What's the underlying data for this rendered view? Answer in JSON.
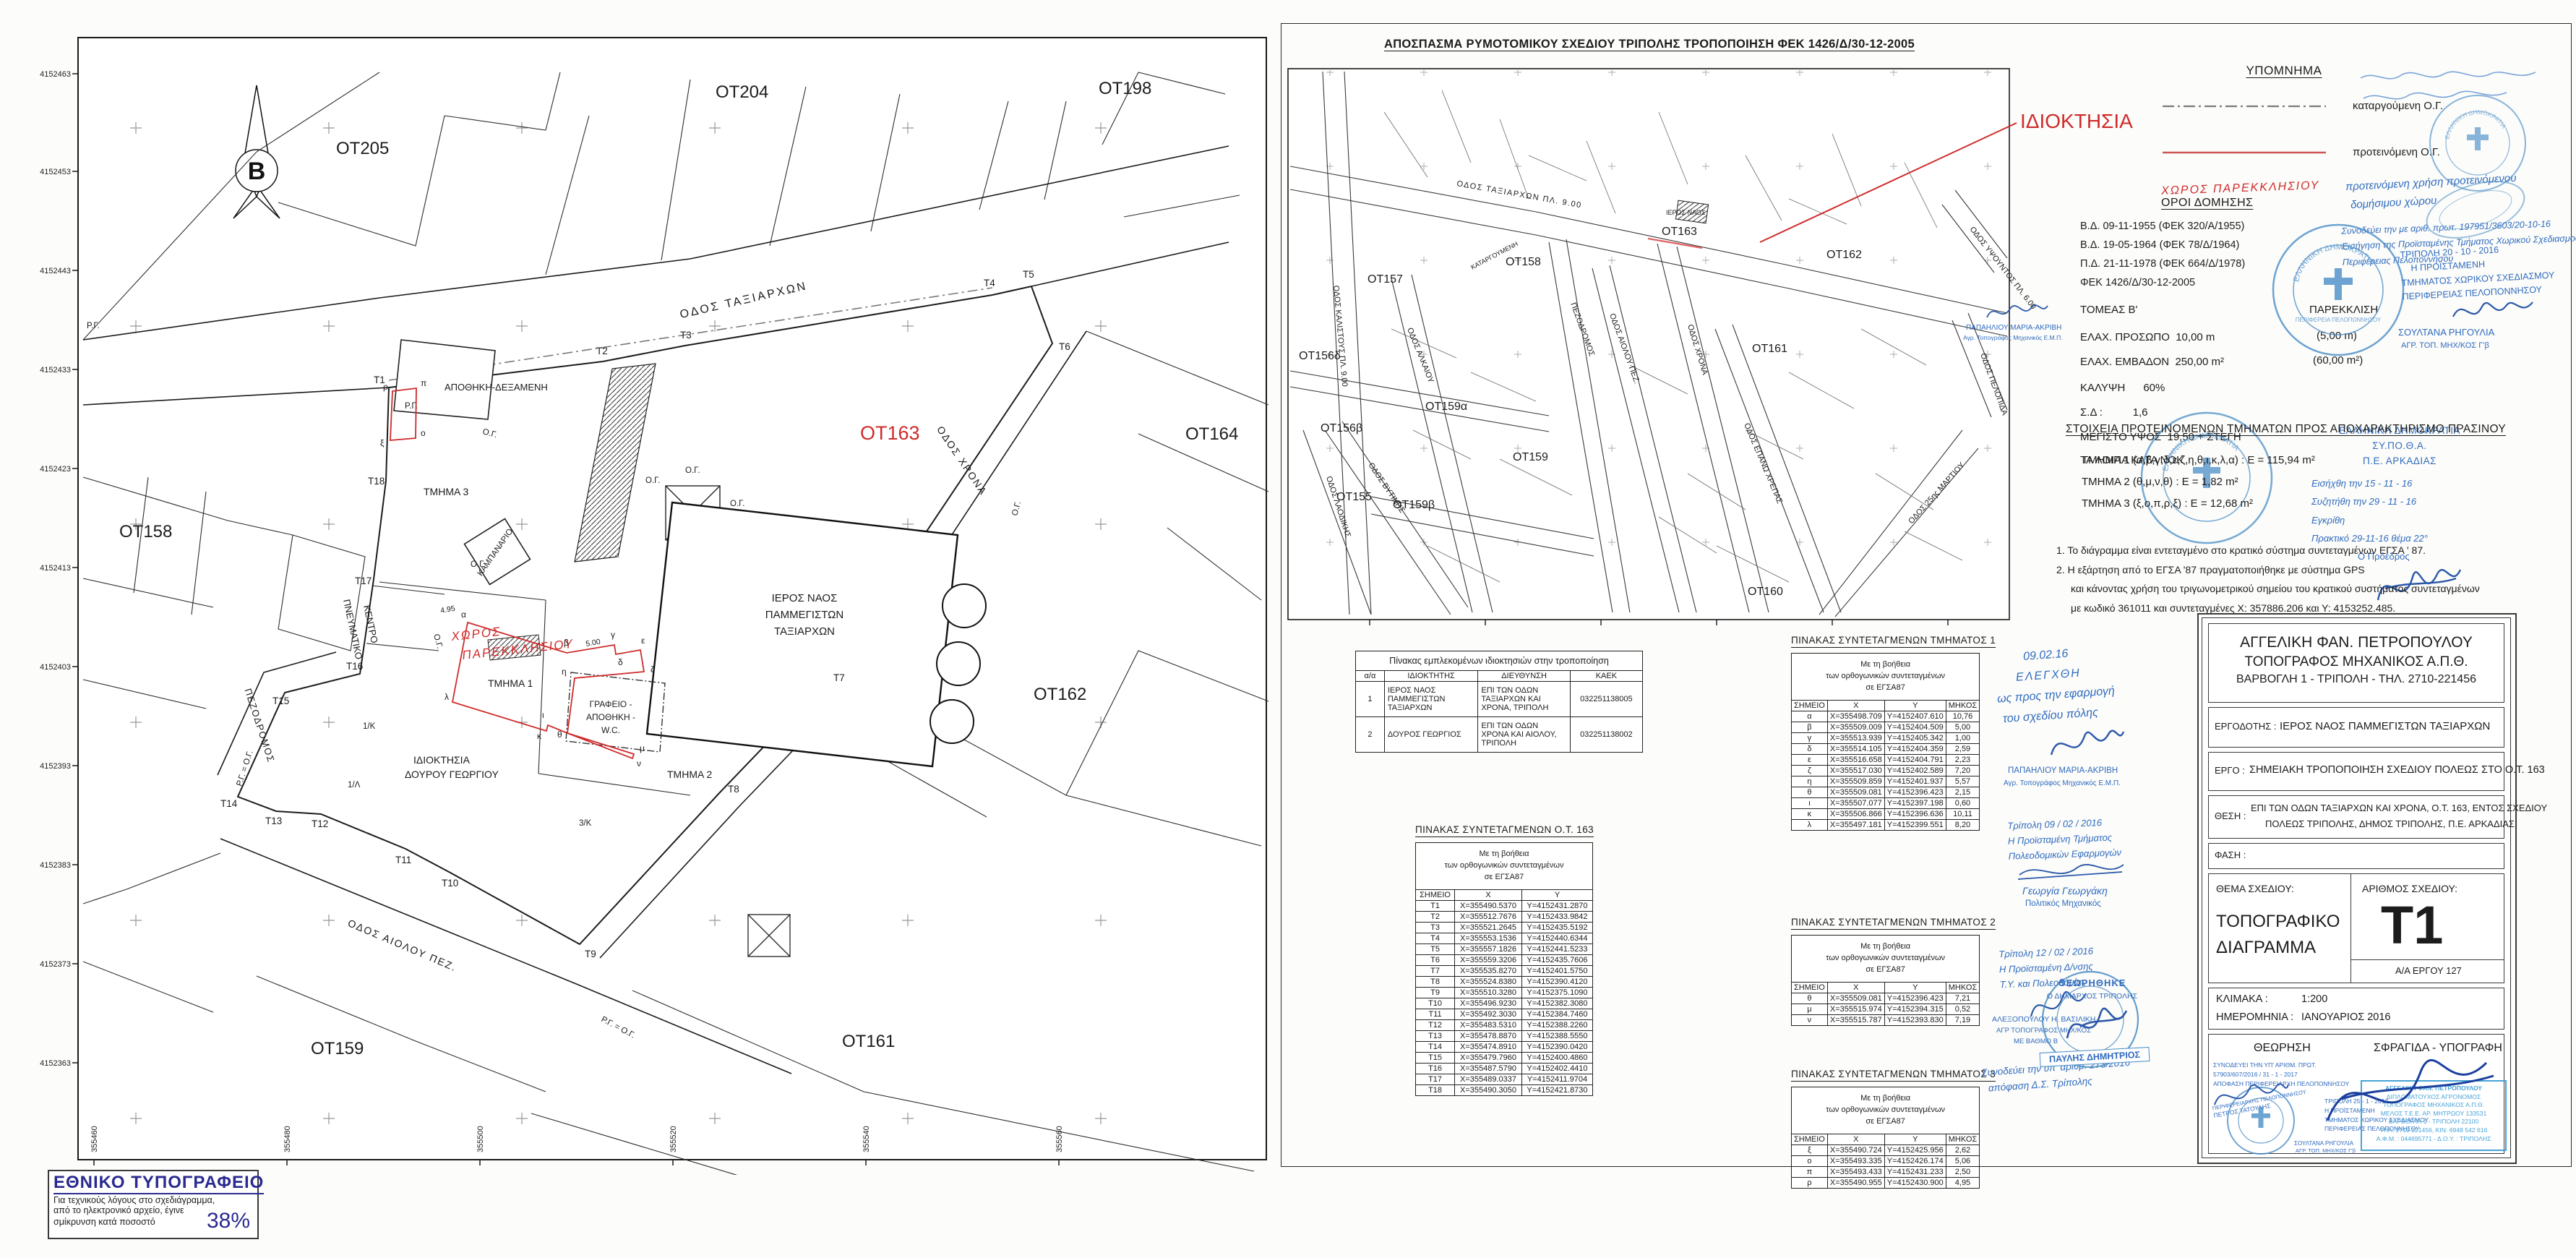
{
  "accent": {
    "red": "#cf2b2b",
    "blue": "#2f6bbe",
    "stamp_blue": "#4a8ec7",
    "cyan": "#3e9fd6"
  },
  "main_map": {
    "north": "B",
    "grid_y": [
      "4152463",
      "4152453",
      "4152443",
      "4152433",
      "4152423",
      "4152413",
      "4152403",
      "4152393",
      "4152383",
      "4152373",
      "4152363"
    ],
    "grid_x": [
      "355460",
      "355480",
      "355500",
      "355520",
      "355540",
      "355560"
    ],
    "blocks": {
      "ot205": "ΟΤ205",
      "ot204": "ΟΤ204",
      "ot198": "ΟΤ198",
      "ot158": "ΟΤ158",
      "ot163": "ΟΤ163",
      "ot164": "ΟΤ164",
      "ot162": "ΟΤ162",
      "ot161": "ΟΤ161",
      "ot159": "ΟΤ159"
    },
    "streets": {
      "taxiarchon": "ΟΔΟΣ ΤΑΞΙΑΡΧΩΝ",
      "chrona": "ΟΔΟΣ ΧΡΟΝΑ",
      "aiolou": "ΟΔΟΣ ΑΙΟΛΟΥ  ΠΕΖ.",
      "pezodromos": "ΠΕΖΟΔΡΟΜΟΣ"
    },
    "features": {
      "church1": "ΙΕΡΟΣ ΝΑΟΣ",
      "church2": "ΠΑΜΜΕΓΙΣΤΩΝ",
      "church3": "ΤΑΞΙΑΡΧΩΝ",
      "belfry": "ΚΑΜΠΑΝΑΡΙΟ",
      "warehouse": "ΑΠΟΘΗΚΗ-ΔΕΞΑΜΕΝΗ",
      "office1": "ΓΡΑΦΕΙΟ -",
      "office2": "ΑΠΟΘΗΚΗ -",
      "office3": "W.C.",
      "cultural1": "ΠΝΕΥΜΑΤΙΚΟ",
      "cultural2": "ΚΕΝΤΡΟ",
      "property1": "ΙΔΙΟΚΤΗΣΙΑ",
      "property2": "ΔΟΥΡΟΥ ΓΕΩΡΓΙΟΥ",
      "tmima1": "ΤΜΗΜΑ 1",
      "tmima2": "ΤΜΗΜΑ 2",
      "tmima3": "ΤΜΗΜΑ 3",
      "chapel1": "ΧΩΡΟΣ",
      "chapel2": "ΠΑΡΕΚΚΛΗΣΙΟΥ"
    },
    "marks": {
      "og": "Ο.Γ.",
      "rg": "Ρ.Γ.",
      "rgog": "Ρ.Γ. = Ο.Γ.",
      "k1": "1/Κ",
      "l1": "1/Λ",
      "k3": "3/Κ",
      "dim495": "4.95",
      "dim500": "5.00"
    },
    "tpoints": [
      "Τ1",
      "Τ2",
      "Τ3",
      "Τ4",
      "Τ5",
      "Τ6",
      "Τ7",
      "Τ8",
      "Τ9",
      "Τ10",
      "Τ11",
      "Τ12",
      "Τ13",
      "Τ14",
      "Τ15",
      "Τ16",
      "Τ17",
      "Τ18"
    ],
    "letters": [
      "α",
      "β",
      "γ",
      "δ",
      "ε",
      "ζ",
      "η",
      "θ",
      "ι",
      "κ",
      "λ",
      "μ",
      "ν",
      "ξ",
      "ο",
      "π",
      "ρ"
    ]
  },
  "extract_map": {
    "title": "ΑΠΟΣΠΑΣΜΑ ΡΥΜΟΤΟΜΙΚΟΥ ΣΧΕΔΙΟΥ ΤΡΙΠΟΛΗΣ ΤΡΟΠΟΠΟΙΗΣΗ ΦΕΚ 1426/Δ/30-12-2005",
    "ownership": "ΙΔΙΟΚΤΗΣΙΑ",
    "church": "ΙΕΡΟΣ ΝΑΟΣ",
    "blocks": {
      "ot155": "ΟΤ155",
      "ot156b": "ΟΤ156β",
      "ot156d": "ΟΤ156δ",
      "ot157": "ΟΤ157",
      "ot158": "ΟΤ158",
      "ot159": "ΟΤ159",
      "ot159a": "ΟΤ159α",
      "ot159b": "ΟΤ159β",
      "ot160": "ΟΤ160",
      "ot161": "ΟΤ161",
      "ot162": "ΟΤ162",
      "ot163": "ΟΤ163"
    },
    "streets": {
      "taxiarchon": "ΟΔΟΣ ΤΑΞΙΑΡΧΩΝ   ΠΛ. 9.00",
      "kalistous": "ΟΔΟΣ ΚΑΛΙΣΤΟΥΣ  ΠΛ. 9.00",
      "alkaiou": "ΟΔΟΣ ΑΛΚΑΙΟΥ",
      "pezodromos": "ΠΕΖΟΔΡΟΜΟΣ",
      "aiolou": "ΟΔΟΣ ΑΙΟΛΟΥ ΠΕΖ.",
      "chrona": "ΟΔΟΣ ΧΡΟΝΑ",
      "ypsountos": "ΟΔΟΣ ΥΨΟΥΝΤΟΣ ΠΛ. 6.00",
      "pelopida": "ΟΔΟΣ ΠΕΛΟΠΙΔΑ",
      "martiou": "ΟΔΟΣ 25ης ΜΑΡΤΙΟΥ",
      "vytinis": "ΟΔΟΣ ΒΥΤΙΝΗΣ",
      "laodikis": "ΟΔΟΣ ΛΑΟΔΙΚΗΣ",
      "epano": "ΟΔΟΣ ΕΠΑΝΩ ΧΡΕΠΑΣ",
      "katargoumeni": "ΚΑΤΑΡΓΟΥΜΕΝΗ"
    }
  },
  "legend": {
    "title": "ΥΠΟΜΝΗΜΑ",
    "abolished": "καταργούμενη Ο.Γ.",
    "proposed": "προτεινόμενη Ο.Γ.",
    "chapel": "ΧΩΡΟΣ ΠΑΡΕΚΚΛΗΣΙΟΥ",
    "use1": "προτεινόμενη χρήση προτεινόμενου",
    "use2": "δομήσιμου χώρου"
  },
  "accompany": {
    "l1": "Συνοδεύει την με αριθ. πρωτ. 197951/3603/20-10-16",
    "l2": "Εισήγηση της Προϊσταμένης Τμήματος Χωρικού Σχεδιασμού",
    "l3": "Περιφέρειας Πελοποννήσου"
  },
  "building_terms": {
    "title": "ΟΡΟΙ ΔΟΜΗΣΗΣ",
    "decrees": [
      "Β.Δ. 09-11-1955 (ΦΕΚ 320/Α/1955)",
      "Β.Δ. 19-05-1964 (ΦΕΚ 78/Δ/1964)",
      "Π.Δ. 21-11-1978 (ΦΕΚ 664/Δ/1978)",
      "ΦΕΚ 1426/Δ/30-12-2005"
    ],
    "sector": "ΤΟΜΕΑΣ Β'",
    "exception": "ΠΑΡΕΚΚΛΙΣΗ",
    "front_label": "ΕΛΑΧ. ΠΡΟΣΩΠΟ",
    "front_value": "10,00 m",
    "front_exc": "(5,00 m)",
    "area_label": "ΕΛΑΧ. ΕΜΒΑΔΟΝ",
    "area_value": "250,00 m²",
    "area_exc": "(60,00 m²)",
    "coverage_label": "ΚΑΛΥΨΗ",
    "coverage_value": "60%",
    "sd_label": "Σ.Δ :",
    "sd_value": "1,6",
    "height_label": "ΜΕΓΙΣΤΟ ΥΨΟΣ",
    "height_value": "19,50 + ΣΤΕΓΗ",
    "rest": "ΤΑ ΛΟΙΠΑ ΚΑΤΑ ΝΟΚ"
  },
  "sections": {
    "title": "ΣΤΟΙΧΕΙΑ ΠΡΟΤΕΙΝΟΜΕΝΩΝ ΤΜΗΜΑΤΩΝ ΠΡΟΣ ΑΠΟΧΑΡΑΚΤΗΡΙΣΜΟ ΠΡΑΣΙΝΟΥ",
    "items": [
      "ΤΜΗΜΑ 1  (α,β,γ,δ,ε,ζ,η,θ,ι,κ,λ,α) : Ε = 115,94 m²",
      "ΤΜΗΜΑ 2  (θ,μ,ν,θ) : Ε = 1,82 m²",
      "ΤΜΗΜΑ 3  (ξ,ο,π,ρ,ξ) : Ε = 12,68 m²"
    ]
  },
  "notes": [
    "1. Το διάγραμμα είναι εντεταγμένο στο κρατικό σύστημα συντεταγμένων ΕΓΣΑ ' 87.",
    "2. Η εξάρτηση από το ΕΓΣΑ '87 πραγματοποιήθηκε με σύστημα GPS",
    "και κάνοντας χρήση του τριγωνομετρικού σημείου του κρατικού συστήματος συντεταγμένων",
    "με κωδικό 361011 και συντεταγμένες Χ: 357886.206 και Υ: 4153252.485."
  ],
  "owners_table": {
    "title": "Πίνακας εμπλεκομένων ιδιοκτησιών στην τροποποίηση",
    "headers": [
      "α/α",
      "ΙΔΙΟΚΤΗΤΗΣ",
      "ΔΙΕΥΘΥΝΣΗ",
      "ΚΑΕΚ"
    ],
    "rows": [
      {
        "aa": "1",
        "owner": "ΙΕΡΟΣ ΝΑΟΣ ΠΑΜΜΕΓΙΣΤΩΝ ΤΑΞΙΑΡΧΩΝ",
        "address": "ΕΠΙ ΤΩΝ ΟΔΩΝ ΤΑΞΙΑΡΧΩΝ ΚΑΙ ΧΡΟΝΑ, ΤΡΙΠΟΛΗ",
        "kaek": "032251138005"
      },
      {
        "aa": "2",
        "owner": "ΔΟΥΡΟΣ ΓΕΩΡΓΙΟΣ",
        "address": "ΕΠΙ ΤΩΝ ΟΔΩΝ ΧΡΟΝΑ ΚΑΙ ΑΙΟΛΟΥ, ΤΡΙΠΟΛΗ",
        "kaek": "032251138002"
      }
    ]
  },
  "coord_common": {
    "sub1": "Με τη βοήθεια",
    "sub2": "των ορθογωνικών συντεταγμένων",
    "sub3": "σε ΕΓΣΑ87",
    "headers": [
      "ΣΗΜΕΙΟ",
      "Χ",
      "Υ",
      "ΜΗΚΟΣ"
    ]
  },
  "coord_tables": {
    "ot163": {
      "title": "ΠΙΝΑΚΑΣ ΣΥΝΤΕΤΑΓΜΕΝΩΝ Ο.Τ. 163",
      "rows": [
        {
          "p": "Τ1",
          "x": "Χ=355490.5370",
          "y": "Υ=4152431.2870"
        },
        {
          "p": "Τ2",
          "x": "Χ=355512.7676",
          "y": "Υ=4152433.9842"
        },
        {
          "p": "Τ3",
          "x": "Χ=355521.2645",
          "y": "Υ=4152435.5192"
        },
        {
          "p": "Τ4",
          "x": "Χ=355553.1536",
          "y": "Υ=4152440.6344"
        },
        {
          "p": "Τ5",
          "x": "Χ=355557.1826",
          "y": "Υ=4152441.5233"
        },
        {
          "p": "Τ6",
          "x": "Χ=355559.3206",
          "y": "Υ=4152435.7606"
        },
        {
          "p": "Τ7",
          "x": "Χ=355535.8270",
          "y": "Υ=4152401.5750"
        },
        {
          "p": "Τ8",
          "x": "Χ=355524.8380",
          "y": "Υ=4152390.4120"
        },
        {
          "p": "Τ9",
          "x": "Χ=355510.3280",
          "y": "Υ=4152375.1090"
        },
        {
          "p": "Τ10",
          "x": "Χ=355496.9230",
          "y": "Υ=4152382.3080"
        },
        {
          "p": "Τ11",
          "x": "Χ=355492.3030",
          "y": "Υ=4152384.7460"
        },
        {
          "p": "Τ12",
          "x": "Χ=355483.5310",
          "y": "Υ=4152388.2260"
        },
        {
          "p": "Τ13",
          "x": "Χ=355478.8870",
          "y": "Υ=4152388.5550"
        },
        {
          "p": "Τ14",
          "x": "Χ=355474.8910",
          "y": "Υ=4152390.0420"
        },
        {
          "p": "Τ15",
          "x": "Χ=355479.7960",
          "y": "Υ=4152400.4860"
        },
        {
          "p": "Τ16",
          "x": "Χ=355487.5790",
          "y": "Υ=4152402.4410"
        },
        {
          "p": "Τ17",
          "x": "Χ=355489.0337",
          "y": "Υ=4152411.9704"
        },
        {
          "p": "Τ18",
          "x": "Χ=355490.3050",
          "y": "Υ=4152421.8730"
        }
      ]
    },
    "tmima1": {
      "title": "ΠΙΝΑΚΑΣ ΣΥΝΤΕΤΑΓΜΕΝΩΝ ΤΜΗΜΑΤΟΣ 1",
      "rows": [
        {
          "p": "α",
          "x": "Χ=355498.709",
          "y": "Υ=4152407.610",
          "len": "10,76"
        },
        {
          "p": "β",
          "x": "Χ=355509.009",
          "y": "Υ=4152404.509",
          "len": "5,00"
        },
        {
          "p": "γ",
          "x": "Χ=355513.939",
          "y": "Υ=4152405.342",
          "len": "1,00"
        },
        {
          "p": "δ",
          "x": "Χ=355514.105",
          "y": "Υ=4152404.359",
          "len": "2,59"
        },
        {
          "p": "ε",
          "x": "Χ=355516.658",
          "y": "Υ=4152404.791",
          "len": "2,23"
        },
        {
          "p": "ζ",
          "x": "Χ=355517.030",
          "y": "Υ=4152402.589",
          "len": "7,20"
        },
        {
          "p": "η",
          "x": "Χ=355509.859",
          "y": "Υ=4152401.937",
          "len": "5,57"
        },
        {
          "p": "θ",
          "x": "Χ=355509.081",
          "y": "Υ=4152396.423",
          "len": "2,15"
        },
        {
          "p": "ι",
          "x": "Χ=355507.077",
          "y": "Υ=4152397.198",
          "len": "0,60"
        },
        {
          "p": "κ",
          "x": "Χ=355506.866",
          "y": "Υ=4152396.636",
          "len": "10,11"
        },
        {
          "p": "λ",
          "x": "Χ=355497.181",
          "y": "Υ=4152399.551",
          "len": "8,20"
        }
      ]
    },
    "tmima2": {
      "title": "ΠΙΝΑΚΑΣ ΣΥΝΤΕΤΑΓΜΕΝΩΝ ΤΜΗΜΑΤΟΣ 2",
      "rows": [
        {
          "p": "θ",
          "x": "Χ=355509.081",
          "y": "Υ=4152396.423",
          "len": "7,21"
        },
        {
          "p": "μ",
          "x": "Χ=355515.974",
          "y": "Υ=4152394.315",
          "len": "0,52"
        },
        {
          "p": "ν",
          "x": "Χ=355515.787",
          "y": "Υ=4152393.830",
          "len": "7,19"
        }
      ]
    },
    "tmima3": {
      "title": "ΠΙΝΑΚΑΣ ΣΥΝΤΕΤΑΓΜΕΝΩΝ ΤΜΗΜΑΤΟΣ 3",
      "rows": [
        {
          "p": "ξ",
          "x": "Χ=355490.724",
          "y": "Υ=4152425.956",
          "len": "2,62"
        },
        {
          "p": "ο",
          "x": "Χ=355493.335",
          "y": "Υ=4152426.174",
          "len": "5,06"
        },
        {
          "p": "π",
          "x": "Χ=355493.433",
          "y": "Υ=4152431.233",
          "len": "2,50"
        },
        {
          "p": "ρ",
          "x": "Χ=355490.955",
          "y": "Υ=4152430.900",
          "len": "4,95"
        }
      ]
    }
  },
  "approvals": {
    "checked": {
      "date": "09.02.16",
      "l1": "ΕΛΕΓΧΘΗ",
      "l2": "ως προς την εφαρμογή",
      "l3": "του σχεδίου πόλης",
      "name": "ΠΑΠΑΗΛΙΟΥ ΜΑΡΙΑ-ΑΚΡΙΒΗ",
      "title": "Αγρ. Τοπογράφος Μηχανικός Ε.Μ.Π."
    },
    "a1": {
      "l1": "Τρίπολη 09 / 02 / 2016",
      "l2": "Η Προϊσταμένη Τμήματος",
      "l3": "Πολεοδομικών Εφαρμογών",
      "name": "Γεωργία Γεωργάκη",
      "title": "Πολιτικός Μηχανικός"
    },
    "a2": {
      "l1": "Τρίπολη 12 / 02 / 2016",
      "l2": "Η Προϊσταμένη Δ/νσης",
      "l3": "Τ.Υ. και Πολεοδομίας",
      "name": "ΑΛΕΞΟΠΟΥΛΟΥ Η. ΒΑΣΙΛΙΚΗ",
      "t1": "ΑΓΡ  ΤΟΠΟΓΡΑΦΟΣ ΜΗΧ/ΚΟΣ",
      "t2": "ΜΕ ΒΑΘΜΟ Β"
    },
    "a3": {
      "l1": "Συνοδεύει την υπ' αριθμ. 273/2016",
      "l2": "απόφαση Δ.Σ. Τρίπολης"
    },
    "mayor": {
      "l1": "ΘΕΩΡΗΘΗΚΕ",
      "l2": "Ο ΔΗΜΑΡΧΟΣ ΤΡΙΠΟΛΗΣ",
      "name": "ΠΑΥΛΗΣ ΔΗΜΗΤΡΙΟΣ"
    }
  },
  "stamps": {
    "region": {
      "ring_top": "ΕΛΛΗΝΙΚΗ ΔΗΜΟΚΡΑΤΙΑ",
      "ring_bottom": "ΠΕΡΙΦΕΡΕΙΑ ΠΕΛΟΠΟΝΝΗΣΟΥ",
      "date": "ΤΡΙΠΟΛΗ 20 - 10 - 2016",
      "l1": "Η ΠΡΟΪΣΤΑΜΕΝΗ",
      "l2": "ΤΜΗΜΑΤΟΣ ΧΩΡΙΚΟΥ ΣΧΕΔΙΑΣΜΟΥ",
      "l3": "ΠΕΡΙΦΕΡΕΙΑΣ ΠΕΛΟΠΟΝΝΗΣΟΥ",
      "name": "ΣΟΥΛΤΑΝΑ ΡΗΓΟΥΛΙΑ",
      "title": "ΑΓΡ. ΤΟΠ. ΜΗΧ/ΚΟΣ Γ'β"
    },
    "sypotha": {
      "ring_top": "ΕΛΛΗΝΙΚΗ ΔΗΜΟΚΡΑΤΙΑ",
      "h1": "ΕΛΛΗΝΙΚΗ ΔΗΜΟΚΡΑΤΙΑ",
      "h2": "ΣΥ.ΠΟ.Θ.Α.",
      "h3": "Π.Ε. ΑΡΚΑΔΙΑΣ",
      "r1": "Εισήχθη την  15 - 11 - 16",
      "r2": "Συζητήθη την  29 - 11 - 16",
      "r3": "Εγκρίθη",
      "r4": "Πρακτικό 29-11-16  θέμα 22°",
      "r5": "Ο Πρόεδρος",
      "name": "Κολλάς Σταύρος",
      "title": "Ηλ/γος Μηχ/κός Β'β"
    }
  },
  "title_block": {
    "name1": "ΑΓΓΕΛΙΚΗ ΦΑΝ. ΠΕΤΡΟΠΟΥΛΟΥ",
    "name2": "ΤΟΠΟΓΡΑΦΟΣ ΜΗΧΑΝΙΚΟΣ Α.Π.Θ.",
    "name3": "ΒΑΡΒΟΓΛΗ 1 - ΤΡΙΠΟΛΗ - ΤΗΛ. 2710-221456",
    "employer_label": "ΕΡΓΟΔΟΤΗΣ :",
    "employer": "ΙΕΡΟΣ ΝΑΟΣ ΠΑΜΜΕΓΙΣΤΩΝ ΤΑΞΙΑΡΧΩΝ",
    "project_label": "ΕΡΓΟ :",
    "project": "ΣΗΜΕΙΑΚΗ ΤΡΟΠΟΠΟΙΗΣΗ ΣΧΕΔΙΟΥ ΠΟΛΕΩΣ ΣΤΟ Ο.Τ. 163",
    "location_label": "ΘΕΣΗ :",
    "location1": "ΕΠΙ ΤΩΝ ΟΔΩΝ ΤΑΞΙΑΡΧΩΝ ΚΑΙ ΧΡΟΝΑ, Ο.Τ. 163, ΕΝΤΟΣ ΣΧΕΔΙΟΥ",
    "location2": "ΠΟΛΕΩΣ ΤΡΙΠΟΛΗΣ, ΔΗΜΟΣ ΤΡΙΠΟΛΗΣ, Π.Ε. ΑΡΚΑΔΙΑΣ",
    "phase_label": "ΦΑΣΗ :",
    "theme_label": "ΘΕΜΑ ΣΧΕΔΙΟΥ:",
    "theme1": "ΤΟΠΟΓΡΑΦΙΚΟ",
    "theme2": "ΔΙΑΓΡΑΜΜΑ",
    "number_label": "ΑΡΙΘΜΟΣ ΣΧΕΔΙΟΥ:",
    "number": "Τ1",
    "project_no": "Α/Α ΕΡΓΟΥ  127",
    "scale_label": "ΚΛΙΜΑΚΑ :",
    "scale": "1:200",
    "date_label": "ΗΜΕΡΟΜΗΝΙΑ :",
    "date": "ΙΑΝΟΥΑΡΙΟΣ  2016",
    "review_label": "ΘΕΩΡΗΣΗ",
    "stamp_label": "ΣΦΡΑΓΙΔΑ - ΥΠΟΓΡΑΦΗ",
    "review_l1": "ΣΥΝΟΔΕΥΕΙ ΤΗΝ ΥΠ' ΑΡΙΘΜ. ΠΡΩΤ.",
    "review_l2": "57903/607/2016 / 31 - 1 - 2017",
    "review_l3": "ΑΠΟΦΑΣΗ ΠΕΡΙΦΕΡΕΙΑΡΧΗ ΠΕΛΟΠΟΝΝΗΣΟΥ",
    "review_d1": "ΤΡΙΠΟΛΗ 25 - 1 - 2017",
    "review_d2": "Η ΠΡΟΪΣΤΑΜΕΝΗ",
    "review_d3": "ΤΜΗΜΑΤΟΣ ΧΩΡΙΚΟΥ ΣΧΕΔΙΑΣΜΟΥ",
    "review_d4": "ΠΕΡΙΦΕΡΕΙΑΣ ΠΕΛΟΠΟΝΝΗΣΟΥ",
    "review_n1": "ΣΟΥΛΤΑΝΑ ΡΗΓΟΥΛΙΑ",
    "review_n2": "ΑΓΡ. ΤΟΠ. ΜΗΧ/ΚΟΣ Γ'β",
    "review_s1": "ΠΕΡΙΦΕΡΕΙΑΡΧΗΣ ΠΕΛΟΠΟΝΝΗΣΟΥ",
    "review_s2": "ΠΕΤΡΟΣ ΤΑΤΟΥΛΗΣ",
    "eng_stamp": [
      "ΑΓΓΕΛΙΚΗ ΦΑΝ. ΠΕΤΡΟΠΟΥΛΟΥ",
      "ΔΙΠΛΩΜΑΤΟΥΧΟΣ ΑΓΡΟΝΟΜΟΣ",
      "ΤΟΠΟΓΡΑΦΟΣ ΜΗΧΑΝΙΚΟΣ Α.Π.Θ.",
      "ΜΕΛΟΣ Τ.Ε.Ε. ΑΡ. ΜΗΤΡΩΟΥ 133531",
      "ΒΑΡΒΟΓΛΗ 1 - ΤΡΙΠΟΛΗ 22100",
      "ΤΗΛ: 2710 221456, ΚΙΝ: 6948 542 616",
      "Α.Φ.Μ. : 044695771 - Δ.Ο.Υ. : ΤΡΙΠΟΛΗΣ"
    ]
  },
  "national_print": {
    "title": "ΕΘΝΙΚΟ ΤΥΠΟΓΡΑΦΕΙΟ",
    "line1": "Για τεχνικούς λόγους στο σχεδιάγραμμα,",
    "line2": "από το ηλεκτρονικό αρχείο, έγινε",
    "line3": "σμίκρυνση κατά ποσοστό",
    "percent": "38%"
  }
}
